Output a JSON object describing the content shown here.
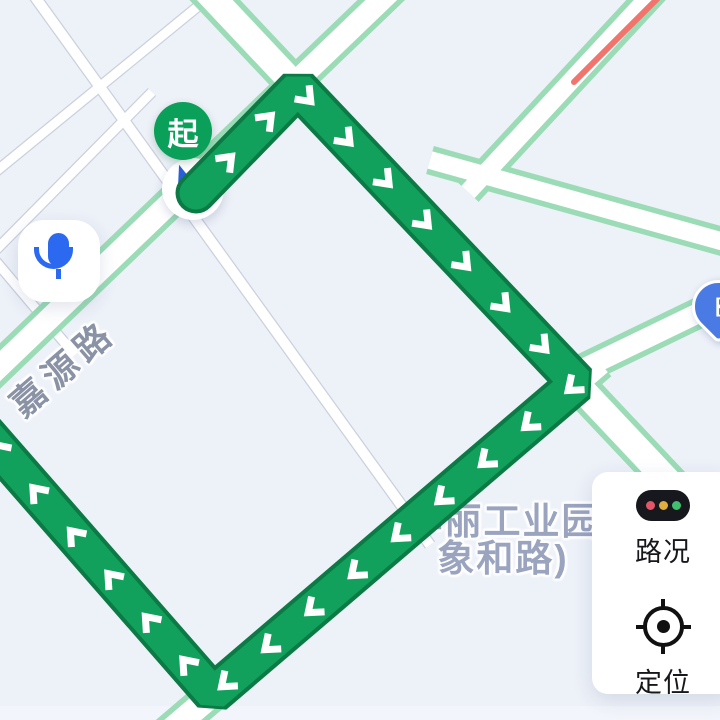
{
  "map": {
    "background": "#edf1f8",
    "bottom_strip_color": "#f2f5fb",
    "road_colors": {
      "minor_fill": "#ffffff",
      "minor_edge": "#ccd0dd",
      "traffic_fill": "#ffffff",
      "traffic_edge": "#9bdcb6",
      "congestion": "#f1746d"
    },
    "roads": [
      {
        "id": "grid-1",
        "type": "minor",
        "width": 10,
        "points": [
          [
            30,
            -10
          ],
          [
            430,
            545
          ]
        ]
      },
      {
        "id": "grid-2",
        "type": "minor",
        "width": 9,
        "points": [
          [
            218,
            -10
          ],
          [
            -12,
            178
          ]
        ]
      },
      {
        "id": "grid-3",
        "type": "minor",
        "width": 9,
        "points": [
          [
            152,
            92
          ],
          [
            -12,
            258
          ]
        ]
      },
      {
        "id": "grid-4",
        "type": "minor",
        "width": 9,
        "points": [
          [
            -12,
            252
          ],
          [
            75,
            355
          ]
        ]
      },
      {
        "id": "jiayuan-road",
        "type": "traffic",
        "width": 22,
        "points": [
          [
            -25,
            390
          ],
          [
            400,
            -18
          ]
        ]
      },
      {
        "id": "main-diagonal-road",
        "type": "traffic",
        "width": 26,
        "points": [
          [
            196,
            -20
          ],
          [
            735,
            552
          ]
        ]
      },
      {
        "id": "bottom-road",
        "type": "traffic",
        "width": 24,
        "points": [
          [
            600,
            363
          ],
          [
            150,
            748
          ]
        ]
      },
      {
        "id": "pin-road",
        "type": "traffic",
        "width": 20,
        "points": [
          [
            560,
            380
          ],
          [
            742,
            292
          ]
        ]
      },
      {
        "id": "branch-road",
        "type": "traffic",
        "width": 18,
        "points": [
          [
            430,
            160
          ],
          [
            735,
            245
          ]
        ]
      },
      {
        "id": "congestion-road",
        "type": "traffic",
        "width": 18,
        "points": [
          [
            468,
            192
          ],
          [
            672,
            -28
          ]
        ]
      }
    ],
    "overlays": [
      {
        "id": "congestion-segment",
        "color": "#f1746d",
        "width": 6,
        "points": [
          [
            574,
            82
          ],
          [
            666,
            -10
          ]
        ]
      }
    ],
    "route": {
      "points": [
        [
          196,
          193
        ],
        [
          298,
          88
        ],
        [
          577,
          383
        ],
        [
          213,
          694
        ],
        [
          -28,
          418
        ]
      ],
      "width": 33,
      "border_width": 41,
      "color": "#12a15c",
      "border_color": "#0b7a44",
      "chevron_color": "#ffffff",
      "chevron_spacing": 57,
      "chevron_start": 45
    },
    "road_label": {
      "text": "嘉源路",
      "color": "#8a92a6",
      "rotation_deg": -41,
      "x": 14,
      "y": 382,
      "font_size": 35,
      "letter_spacing": 7
    },
    "poi_label": {
      "line1": "华丽工业园",
      "line2": "象和路)",
      "color": "#9aa4bf",
      "x": 398,
      "y": 503,
      "width": 210,
      "font_size": 37
    }
  },
  "markers": {
    "start": {
      "label": "起",
      "bg": "#0aa05a",
      "cx": 183,
      "cy": 131,
      "diameter": 58
    },
    "position": {
      "icon": "navigation-arrow-icon",
      "arrow_color": "#2b5fd9",
      "cx": 193,
      "cy": 189,
      "diameter": 62
    },
    "ev_pin": {
      "icon": "charging-station-icon",
      "bg": "#4a7ae4",
      "bracket": "[",
      "x": 692,
      "y": 280,
      "size": 47
    }
  },
  "controls": {
    "mic": {
      "icon": "microphone-icon",
      "color": "#2b6af0",
      "x": 18,
      "y": 220,
      "size": 82
    },
    "panel": {
      "x": 592,
      "y": 472,
      "width": 108,
      "height": 222,
      "traffic": {
        "icon": "traffic-light-icon",
        "label": "路况",
        "pill_color": "#16181d",
        "dot_colors": [
          "#e25767",
          "#dfae3e",
          "#3fbf6f"
        ]
      },
      "locate": {
        "icon": "crosshair-icon",
        "label": "定位"
      }
    }
  }
}
